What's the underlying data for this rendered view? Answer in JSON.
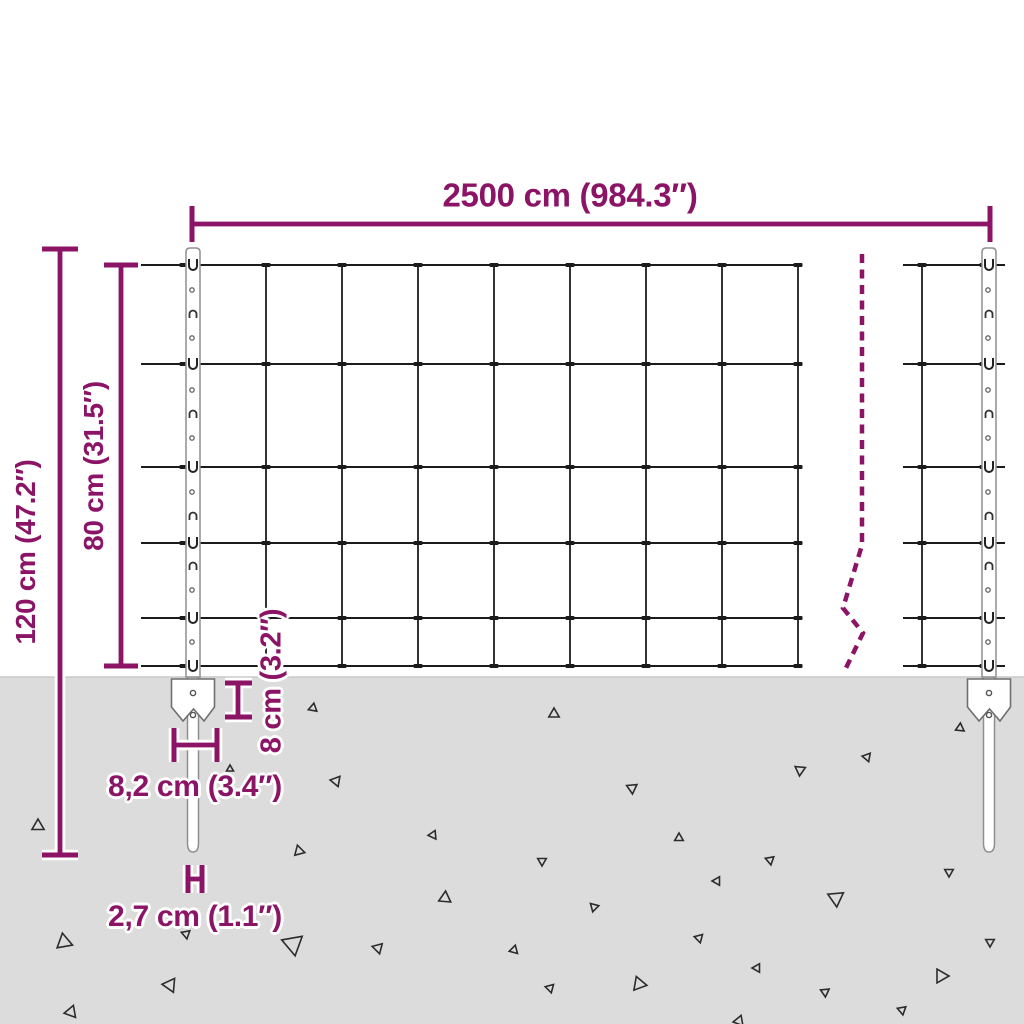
{
  "diagram": {
    "labels": {
      "width": "2500 cm (984.3″)",
      "total_height": "120 cm (47.2″)",
      "mesh_height": "80 cm (31.5″)",
      "plate_height": "8 cm (3.2″)",
      "plate_width": "8,2 cm (3.4″)",
      "spike_width": "2,7 cm (1.1″)"
    },
    "colors": {
      "accent": "#8C1466",
      "wire": "#1b1b1b",
      "ground": "#dcdcdc",
      "ground_edge": "#c9c9c9",
      "post_fill": "#ffffff",
      "post_stroke": "#8f8f8f",
      "triangle": "#2c2c2c",
      "casing": "#ffffff"
    },
    "fence": {
      "wire_ys": [
        265,
        364,
        467,
        543,
        618,
        666
      ],
      "main_span_x": [
        141,
        800
      ],
      "main_vertical_xs": [
        266,
        342,
        418,
        494,
        570,
        646,
        722,
        798
      ],
      "right_span_x": [
        903,
        1005
      ],
      "right_vertical_xs": [
        922
      ],
      "left_post_cx": 193,
      "right_post_cx": 989,
      "post_top_y": 248,
      "post_width": 14,
      "ground_y": 677,
      "spike_bottom_y": 852,
      "plate": {
        "top": 679,
        "side_bottom": 707,
        "tip": 721,
        "notch": 709,
        "half_w": 21.5,
        "hole_ys": [
          693,
          715
        ]
      },
      "clip_circle_ys": [
        290,
        338,
        390,
        438,
        492,
        590,
        642
      ],
      "clip_n_ys": [
        314,
        414,
        516,
        566
      ],
      "break_line_points": "862,254 862,545 843,608 863,633 845,670"
    },
    "dim_lines": [
      {
        "name": "dim-fence-length",
        "line": [
          192,
          224,
          990,
          224
        ],
        "ticks": [
          [
            192,
            206,
            192,
            242
          ],
          [
            990,
            206,
            990,
            242
          ]
        ]
      },
      {
        "name": "dim-total-height",
        "line": [
          60,
          249,
          60,
          855
        ],
        "ticks": [
          [
            42,
            249,
            78,
            249
          ],
          [
            42,
            855,
            78,
            855
          ]
        ]
      },
      {
        "name": "dim-mesh-height",
        "line": [
          121,
          265,
          121,
          666
        ],
        "ticks": [
          [
            104,
            265,
            138,
            265
          ],
          [
            104,
            666,
            138,
            666
          ]
        ]
      },
      {
        "name": "dim-plate-height",
        "line": [
          238,
          683,
          238,
          717
        ],
        "ticks": [
          [
            225,
            683,
            252,
            683
          ],
          [
            225,
            717,
            252,
            717
          ]
        ]
      },
      {
        "name": "dim-plate-width",
        "line": [
          174,
          745,
          217,
          745
        ],
        "ticks": [
          [
            174,
            728,
            174,
            762
          ],
          [
            217,
            728,
            217,
            762
          ]
        ]
      },
      {
        "name": "dim-spike-width",
        "line": [
          188,
          879,
          202,
          879
        ],
        "ticks": [
          [
            188,
            865,
            188,
            893
          ],
          [
            202,
            865,
            202,
            893
          ]
        ]
      }
    ],
    "triangles": [
      [
        38,
        826,
        7,
        0
      ],
      [
        313,
        708,
        5,
        10
      ],
      [
        336,
        781,
        6,
        40
      ],
      [
        299,
        851,
        6,
        -15
      ],
      [
        433,
        835,
        5,
        25
      ],
      [
        445,
        898,
        7,
        5
      ],
      [
        64,
        942,
        9,
        -10
      ],
      [
        293,
        944,
        12,
        50
      ],
      [
        170,
        985,
        8,
        35
      ],
      [
        71,
        1012,
        7,
        20
      ],
      [
        186,
        934,
        5,
        170
      ],
      [
        378,
        948,
        6,
        45
      ],
      [
        230,
        769,
        4,
        120
      ],
      [
        554,
        714,
        6,
        0
      ],
      [
        632,
        788,
        6,
        55
      ],
      [
        800,
        770,
        6,
        65
      ],
      [
        867,
        757,
        5,
        40
      ],
      [
        960,
        728,
        5,
        5
      ],
      [
        679,
        838,
        5,
        0
      ],
      [
        542,
        861,
        5,
        60
      ],
      [
        770,
        860,
        5,
        50
      ],
      [
        717,
        881,
        5,
        30
      ],
      [
        836,
        898,
        9,
        55
      ],
      [
        594,
        907,
        5,
        75
      ],
      [
        949,
        872,
        5,
        60
      ],
      [
        699,
        938,
        5,
        45
      ],
      [
        514,
        950,
        5,
        15
      ],
      [
        757,
        968,
        5,
        30
      ],
      [
        639,
        984,
        8,
        -20
      ],
      [
        550,
        988,
        5,
        45
      ],
      [
        825,
        992,
        5,
        55
      ],
      [
        941,
        976,
        8,
        -30
      ],
      [
        990,
        942,
        5,
        60
      ],
      [
        902,
        1010,
        5,
        50
      ],
      [
        739,
        1021,
        6,
        140
      ]
    ]
  }
}
